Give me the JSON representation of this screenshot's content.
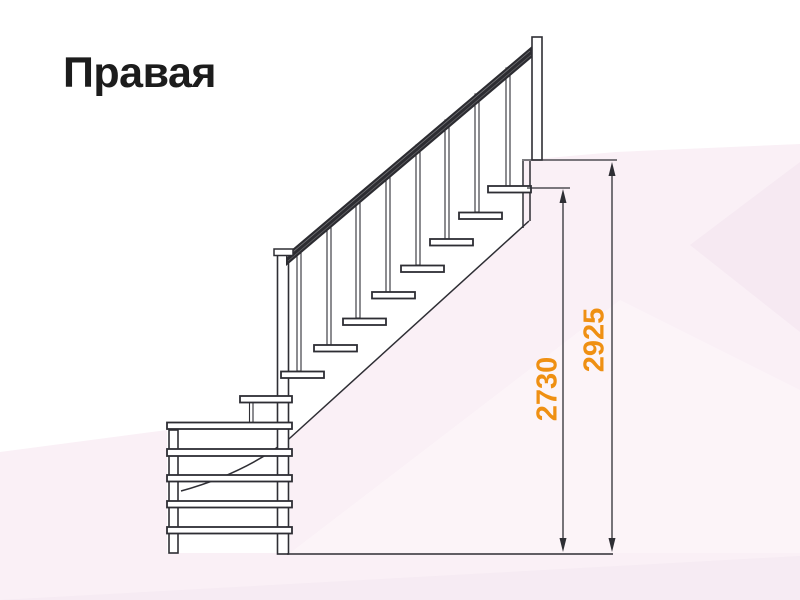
{
  "title": {
    "text": "Правая"
  },
  "drawing": {
    "name": "staircase-side-view",
    "description": "right-hand winder staircase elevation",
    "dimensions": [
      {
        "id": "dim-2730",
        "value": "2730"
      },
      {
        "id": "dim-2925",
        "value": "2925"
      }
    ]
  },
  "colors": {
    "accent_orange": "#EF9013",
    "line_dark": "#2E2E34",
    "background_pink": "#FAF0F6",
    "title_black": "#1C1C1C"
  }
}
